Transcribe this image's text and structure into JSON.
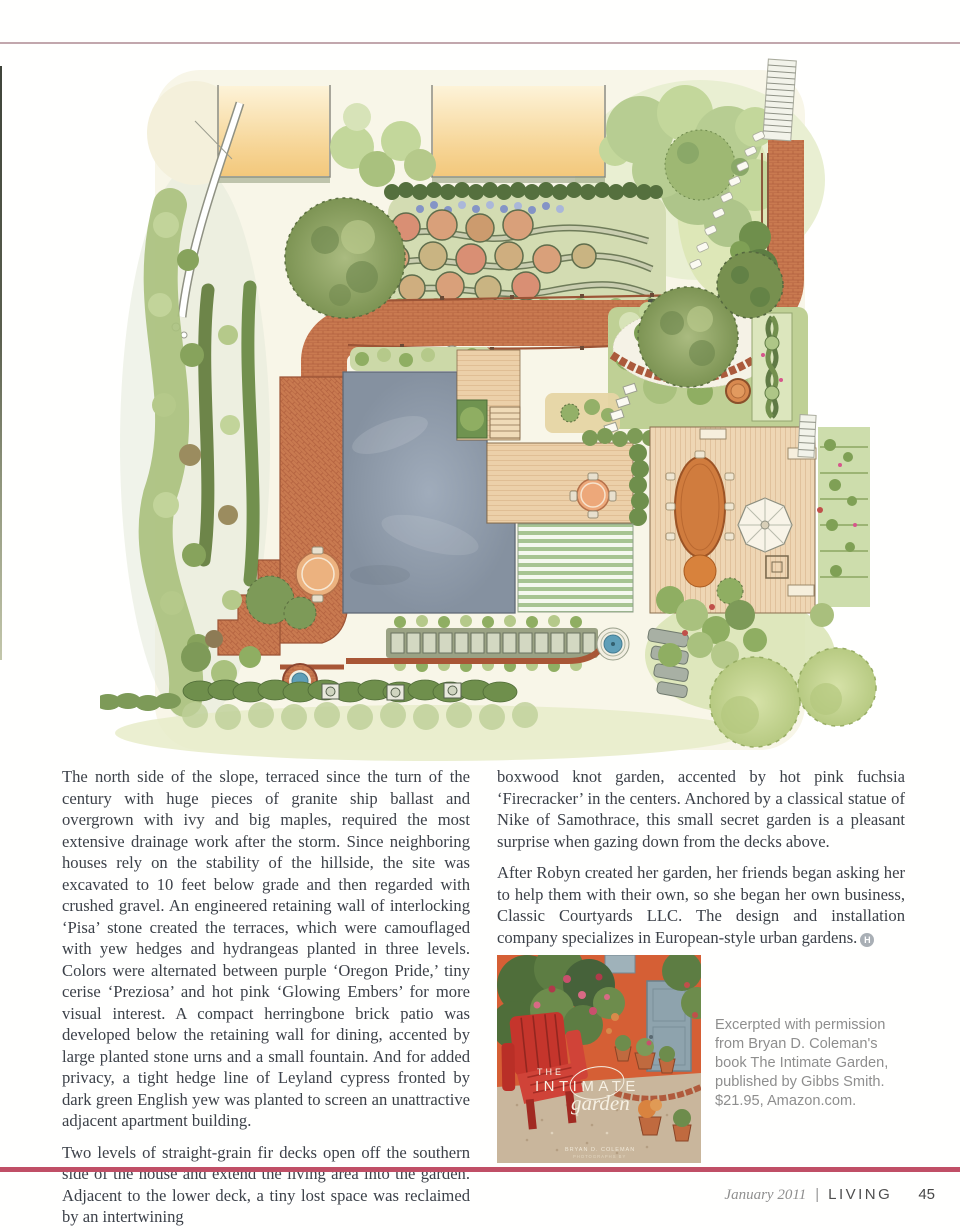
{
  "palette": {
    "top_rule": "#c2a7ad",
    "bottom_rule": "#c04f66",
    "body_text": "#3c4149",
    "caption_text": "#8e8e8e",
    "footer_text": "#8f8f8f",
    "footer_mag": "#4f4f4f"
  },
  "illustration": {
    "alt": "Watercolor landscape plan: brick paths, house roof, fir decks, striped lawn, vegetable beds, fountain and hedges"
  },
  "article": {
    "left_column": {
      "p1": "The north side of the slope, terraced since the turn of the century with huge pieces of granite ship ballast and overgrown with ivy and big maples, required the most extensive drainage work after the storm. Since neighboring houses rely on the stability of the hillside, the site was excavated to 10 feet below grade and then regarded with crushed gravel. An engineered retaining wall of interlocking ‘Pisa’ stone created the terraces, which were camouflaged with yew hedges and hydrangeas planted in three levels. Colors were alternated between purple ‘Oregon Pride,’ tiny cerise ‘Preziosa’ and hot pink ‘Glowing Embers’ for more visual interest. A compact herringbone brick patio was developed below the retaining wall for dining, accented by large planted stone urns and a small fountain. And for added privacy, a tight hedge line of Leyland cypress fronted by dark green English yew was planted to screen an unattractive adjacent apartment building.",
      "p2": "Two levels of straight-grain fir decks open off the southern side of the house and extend the living area into the garden. Adjacent to the lower deck, a tiny lost space was reclaimed by an intertwining"
    },
    "right_column": {
      "p1": "boxwood knot garden, accented by hot pink fuchsia ‘Firecracker’ in the centers. Anchored by a classical statue of Nike of Samothrace, this small secret garden is a pleasant surprise when gazing down from the decks above.",
      "p2": "After Robyn created her garden, her friends began asking her to help them with their own, so she began her own business, Classic Courtyards LLC. The design and installation company specializes in European-style urban gardens.",
      "end_mark": "H"
    }
  },
  "book": {
    "cover": {
      "kicker": "THE",
      "title": "INTIMATE",
      "script_title": "garden",
      "author": "BRYAN D. COLEMAN",
      "credit": "PHOTOGRAPHS BY"
    },
    "caption_lines": [
      "Excerpted with permission",
      "from Bryan D. Coleman's",
      "book The Intimate Garden,",
      "published by Gibbs Smith.",
      "$21.95, Amazon.com."
    ]
  },
  "footer": {
    "issue": "January 2011",
    "separator": "|",
    "magazine": "LIVING",
    "page_number": "45"
  }
}
